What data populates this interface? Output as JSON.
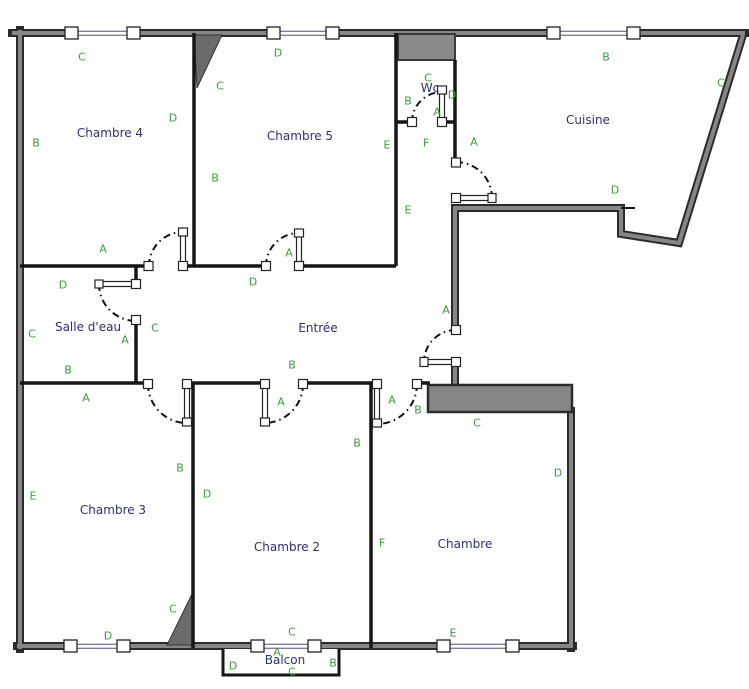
{
  "colors": {
    "wall_fill": "#868686",
    "wall_edge": "#2b2b2b",
    "interior_wall": "#161616",
    "room_label": "#2e2e7e",
    "wall_letter": "#3d9b3d",
    "glazing": "#7d7da8",
    "background": "#ffffff"
  },
  "rooms": [
    {
      "name": "Chambre 4",
      "x": 110,
      "y": 133
    },
    {
      "name": "Chambre 5",
      "x": 300,
      "y": 136
    },
    {
      "name": "Wc",
      "x": 430,
      "y": 88
    },
    {
      "name": "Cuisine",
      "x": 588,
      "y": 120
    },
    {
      "name": "Salle d'eau",
      "x": 88,
      "y": 327
    },
    {
      "name": "Entrée",
      "x": 318,
      "y": 328
    },
    {
      "name": "Chambre 3",
      "x": 113,
      "y": 510
    },
    {
      "name": "Chambre 2",
      "x": 287,
      "y": 547
    },
    {
      "name": "Chambre",
      "x": 465,
      "y": 544
    },
    {
      "name": "Balcon",
      "x": 285,
      "y": 660
    }
  ],
  "wall_labels": [
    {
      "t": "C",
      "x": 82,
      "y": 57
    },
    {
      "t": "D",
      "x": 278,
      "y": 53
    },
    {
      "t": "C",
      "x": 428,
      "y": 78
    },
    {
      "t": "B",
      "x": 606,
      "y": 57
    },
    {
      "t": "C",
      "x": 721,
      "y": 83
    },
    {
      "t": "B",
      "x": 36,
      "y": 143
    },
    {
      "t": "D",
      "x": 173,
      "y": 118
    },
    {
      "t": "C",
      "x": 220,
      "y": 86
    },
    {
      "t": "B",
      "x": 215,
      "y": 178
    },
    {
      "t": "B",
      "x": 408,
      "y": 101
    },
    {
      "t": "A",
      "x": 437,
      "y": 112
    },
    {
      "t": "D",
      "x": 452,
      "y": 95
    },
    {
      "t": "E",
      "x": 387,
      "y": 145
    },
    {
      "t": "F",
      "x": 426,
      "y": 143
    },
    {
      "t": "A",
      "x": 474,
      "y": 142
    },
    {
      "t": "E",
      "x": 408,
      "y": 210
    },
    {
      "t": "D",
      "x": 615,
      "y": 190
    },
    {
      "t": "A",
      "x": 103,
      "y": 249
    },
    {
      "t": "A",
      "x": 289,
      "y": 253
    },
    {
      "t": "D",
      "x": 63,
      "y": 285
    },
    {
      "t": "D",
      "x": 253,
      "y": 282
    },
    {
      "t": "C",
      "x": 32,
      "y": 334
    },
    {
      "t": "A",
      "x": 125,
      "y": 340
    },
    {
      "t": "C",
      "x": 155,
      "y": 328
    },
    {
      "t": "B",
      "x": 68,
      "y": 370
    },
    {
      "t": "B",
      "x": 292,
      "y": 365
    },
    {
      "t": "A",
      "x": 446,
      "y": 310
    },
    {
      "t": "A",
      "x": 86,
      "y": 398
    },
    {
      "t": "A",
      "x": 281,
      "y": 402
    },
    {
      "t": "A",
      "x": 392,
      "y": 400
    },
    {
      "t": "B",
      "x": 418,
      "y": 410
    },
    {
      "t": "B",
      "x": 180,
      "y": 468
    },
    {
      "t": "B",
      "x": 357,
      "y": 443
    },
    {
      "t": "C",
      "x": 477,
      "y": 423
    },
    {
      "t": "E",
      "x": 33,
      "y": 496
    },
    {
      "t": "D",
      "x": 207,
      "y": 494
    },
    {
      "t": "D",
      "x": 558,
      "y": 473
    },
    {
      "t": "F",
      "x": 382,
      "y": 543
    },
    {
      "t": "C",
      "x": 173,
      "y": 609
    },
    {
      "t": "D",
      "x": 108,
      "y": 636
    },
    {
      "t": "C",
      "x": 292,
      "y": 632
    },
    {
      "t": "E",
      "x": 453,
      "y": 633
    },
    {
      "t": "A",
      "x": 277,
      "y": 652
    },
    {
      "t": "D",
      "x": 233,
      "y": 666
    },
    {
      "t": "B",
      "x": 333,
      "y": 663
    },
    {
      "t": "C",
      "x": 292,
      "y": 672
    }
  ]
}
